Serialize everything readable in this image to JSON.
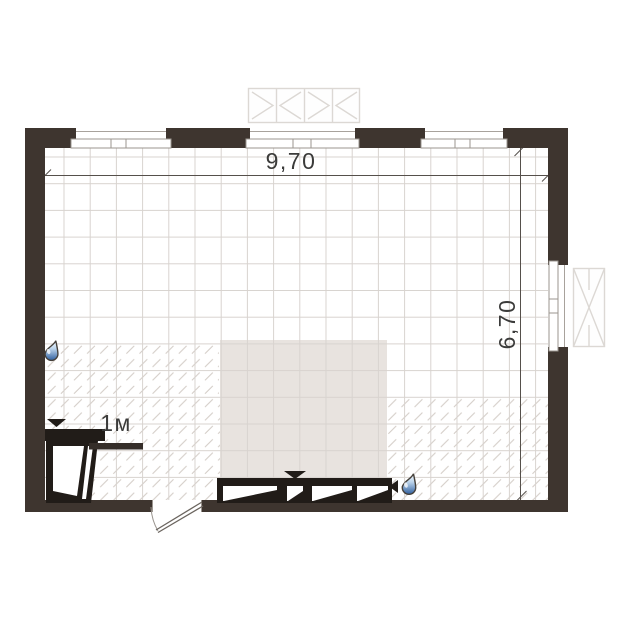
{
  "title": "Room floor plan",
  "dimensions": {
    "width_label": "9,70",
    "height_label": "6,70",
    "scale_label": "1м"
  },
  "colors": {
    "wall": "#3e352f",
    "fixture": "#211c18",
    "rug": "#e8e3df",
    "floor": "#ffffff",
    "grid_line": "#d8d3cf",
    "hatch_line": "#d2cbc5",
    "dimension_line": "#55504b",
    "drop_blue": "#2f5f9e"
  },
  "icons": [
    {
      "name": "water-drop-icon"
    },
    {
      "name": "water-drop-icon"
    },
    {
      "name": "arrow-down-icon"
    },
    {
      "name": "arrow-down-icon"
    },
    {
      "name": "arrow-left-icon"
    }
  ]
}
